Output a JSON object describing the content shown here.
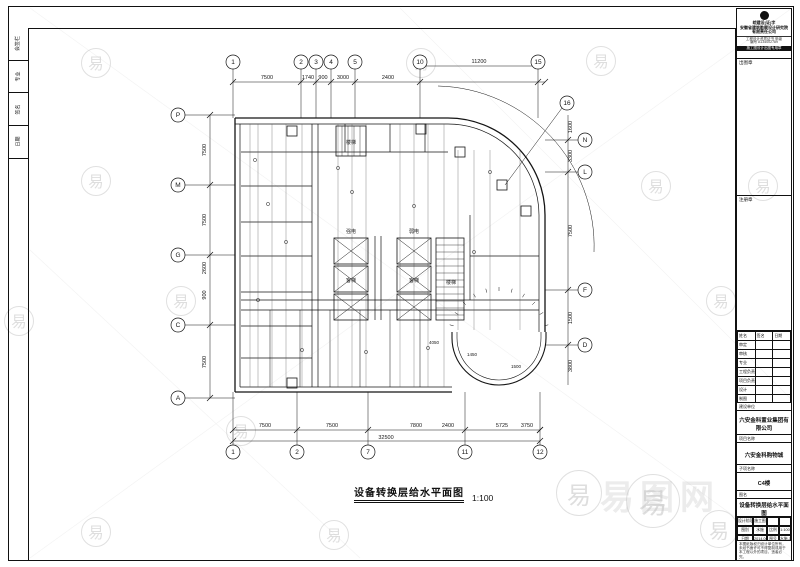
{
  "sheet": {
    "title": "设备转换层给水平面图",
    "scale": "1:100",
    "watermark_char": "易",
    "watermark_site": "易图网"
  },
  "stamp": {
    "lines": [
      "皖建设(证)字",
      "安徽省建筑勘察设计研究院",
      "有限责任公司"
    ],
    "sub_lines": [
      "工程设计资质证书 甲级",
      "编号 A134002789"
    ],
    "bar": "施工图设计出图专用章"
  },
  "left_strip": {
    "labels": [
      "会签栏",
      "专业",
      "签名",
      "日期"
    ]
  },
  "right_panel": {
    "box1_label": "出图章",
    "box2_label": "注册章",
    "sig": {
      "headers": [
        "姓名",
        "签名",
        "日期"
      ],
      "rows": [
        "审定",
        "审核",
        "专业",
        "工程负责人",
        "项目负责人",
        "设计",
        "制图"
      ]
    },
    "sections": [
      {
        "label": "建设单位",
        "value": "六安金科置业集团有限公司"
      },
      {
        "label": "项目名称",
        "value": "六安金科购物城"
      },
      {
        "label": "子项名称",
        "value": "C4楼"
      },
      {
        "label": "图名",
        "value": "设备转换层给水平面图"
      }
    ],
    "info_rows": [
      [
        "设计阶段",
        "施工图",
        "",
        ""
      ],
      [
        "图别",
        "水施",
        "比例",
        "1:100"
      ],
      [
        "日期",
        "2014.06",
        "图号",
        "水施-10"
      ]
    ],
    "note": "本图纸版权归设计单位所有，未经书面许可不得复制或用于本工程以外的项目，违者必究。"
  },
  "plan": {
    "bubbles_top": [
      [
        233,
        "1"
      ],
      [
        301,
        "2"
      ],
      [
        316,
        "3"
      ],
      [
        331,
        "4"
      ],
      [
        355,
        "5"
      ],
      [
        420,
        "10"
      ],
      [
        538,
        "15"
      ]
    ],
    "bubbles_bottom": [
      [
        233,
        "1"
      ],
      [
        297,
        "2"
      ],
      [
        368,
        "7"
      ],
      [
        465,
        "11"
      ],
      [
        540,
        "12"
      ]
    ],
    "bubbles_left": [
      [
        115,
        "P"
      ],
      [
        185,
        "M"
      ],
      [
        255,
        "G"
      ],
      [
        325,
        "C"
      ],
      [
        398,
        "A"
      ]
    ],
    "bubbles_right": [
      [
        140,
        "N"
      ],
      [
        172,
        "L"
      ],
      [
        290,
        "F"
      ],
      [
        345,
        "D"
      ]
    ],
    "bubble_leader": [
      567,
      103,
      "16"
    ],
    "dims_top": [
      [
        267,
        79,
        "7500"
      ],
      [
        308,
        79,
        "1740"
      ],
      [
        323,
        79,
        "900"
      ],
      [
        343,
        79,
        "3000"
      ],
      [
        388,
        79,
        "2400"
      ],
      [
        479,
        63,
        "11200"
      ]
    ],
    "dims_bottom": [
      [
        265,
        427,
        "7500"
      ],
      [
        332,
        427,
        "7500"
      ],
      [
        416,
        427,
        "7800"
      ],
      [
        448,
        427,
        "2400"
      ],
      [
        502,
        427,
        "5725"
      ],
      [
        527,
        427,
        "3750"
      ]
    ],
    "dim_overall": [
      386,
      439,
      "32500"
    ],
    "dims_left": [
      [
        150,
        "7500"
      ],
      [
        220,
        "7500"
      ],
      [
        268,
        "2600"
      ],
      [
        295,
        "900"
      ],
      [
        362,
        "7500"
      ]
    ],
    "dims_right": [
      [
        127,
        "1600"
      ],
      [
        156,
        "3300"
      ],
      [
        231,
        "7500"
      ],
      [
        318,
        "1500"
      ],
      [
        366,
        "3800"
      ]
    ],
    "inner_dims": [
      [
        434,
        344,
        "4050"
      ],
      [
        472,
        356,
        "1450"
      ],
      [
        516,
        368,
        "1500"
      ]
    ],
    "room_labels": [
      [
        351,
        233,
        "强电"
      ],
      [
        414,
        233,
        "弱电"
      ],
      [
        351,
        282,
        "客梯"
      ],
      [
        414,
        282,
        "客梯"
      ],
      [
        451,
        284,
        "楼梯"
      ],
      [
        351,
        144,
        "楼梯"
      ]
    ],
    "elevators": [
      [
        334,
        238
      ],
      [
        334,
        266
      ],
      [
        334,
        294
      ],
      [
        397,
        238
      ],
      [
        397,
        266
      ],
      [
        397,
        294
      ]
    ],
    "elevator_size": [
      34,
      26
    ],
    "stairs": [
      [
        336,
        126,
        30,
        30,
        6,
        "v"
      ],
      [
        436,
        238,
        28,
        82,
        7,
        "h"
      ]
    ],
    "equip": [
      [
        416,
        124
      ],
      [
        455,
        147
      ],
      [
        497,
        180
      ],
      [
        521,
        206
      ],
      [
        287,
        126
      ],
      [
        287,
        378
      ]
    ],
    "risers_full": [
      250,
      258,
      272,
      286,
      302,
      338,
      352,
      366,
      400,
      414,
      428,
      444
    ],
    "risers_part": [
      458,
      474,
      490,
      520
    ],
    "riser_dots": [
      [
        255,
        160
      ],
      [
        268,
        204
      ],
      [
        286,
        242
      ],
      [
        352,
        192
      ],
      [
        414,
        206
      ],
      [
        474,
        252
      ],
      [
        490,
        172
      ],
      [
        302,
        350
      ],
      [
        366,
        352
      ],
      [
        428,
        348
      ],
      [
        258,
        300
      ],
      [
        338,
        168
      ]
    ]
  },
  "watermarks": [
    [
      95,
      62,
      28
    ],
    [
      420,
      62,
      28
    ],
    [
      655,
      185,
      28
    ],
    [
      762,
      185,
      28
    ],
    [
      18,
      320,
      28
    ],
    [
      180,
      300,
      28
    ],
    [
      95,
      531,
      28
    ],
    [
      333,
      534,
      28
    ],
    [
      240,
      430,
      28
    ],
    [
      600,
      60,
      28
    ],
    [
      720,
      300,
      28
    ],
    [
      95,
      180,
      28
    ],
    [
      578,
      492,
      44
    ],
    [
      652,
      500,
      52
    ],
    [
      718,
      528,
      36
    ]
  ]
}
